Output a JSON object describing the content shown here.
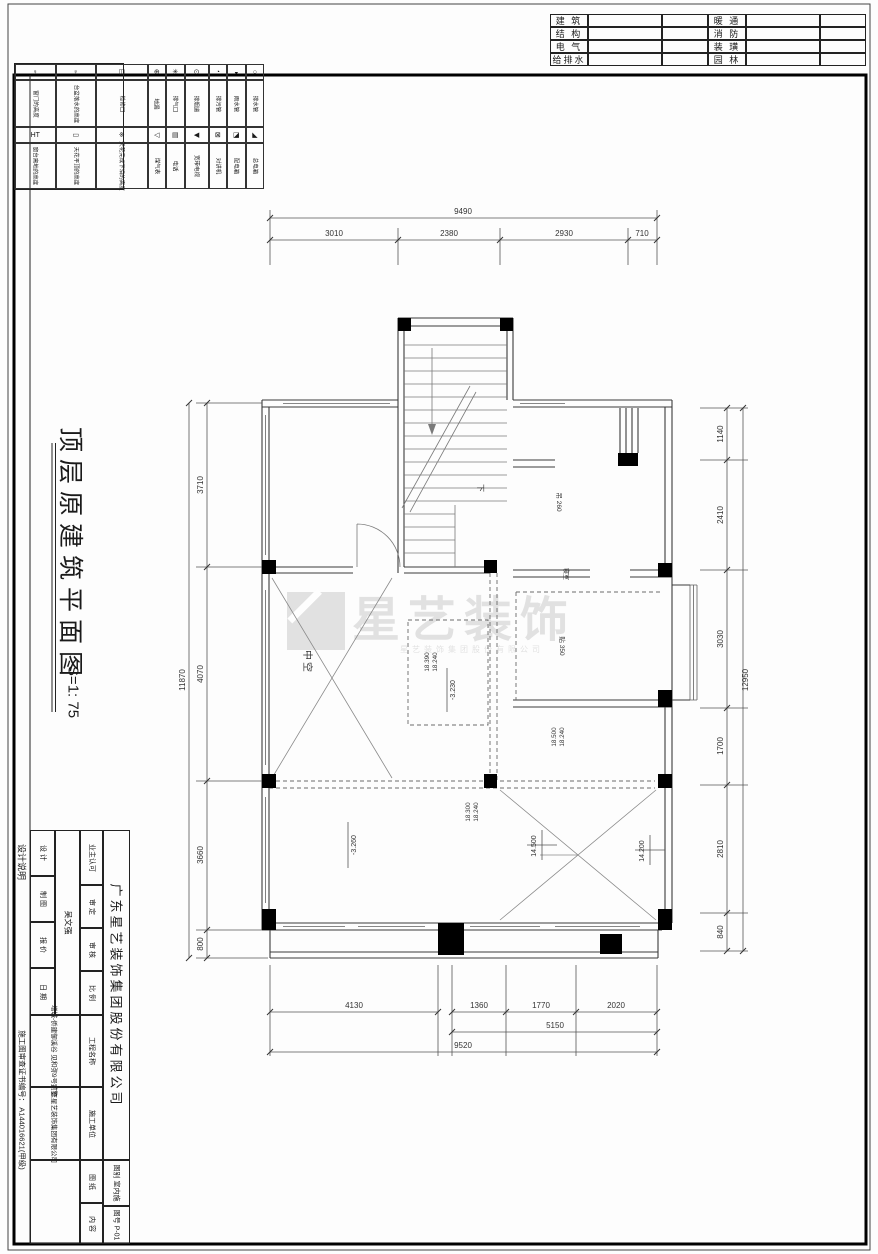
{
  "sheet": {
    "disciplines": {
      "left": [
        "建 筑",
        "结 构",
        "电 气",
        "给排水"
      ],
      "right": [
        "暖 通",
        "消 防",
        "装 璜",
        "园 林"
      ]
    },
    "legend": {
      "columns": [
        {
          "sym1": "♀",
          "label1": "窗门的高度",
          "sym2": "HT",
          "label2": "窗台离地的高度"
        },
        {
          "sym1": "♀",
          "label1": "台盆落水的高度",
          "sym2": "▭",
          "label2": "天花平顶的高度"
        },
        {
          "sym1": "◫",
          "label1": "检修口",
          "sym2": "※",
          "label2": "天花完成下沿的高度"
        },
        {
          "sym1": "⊕",
          "label1": "地漏",
          "sym2": "◁",
          "label2": "煤气表"
        },
        {
          "sym1": "✳",
          "label1": "排气口",
          "sym2": "▤",
          "label2": "电话"
        },
        {
          "sym1": "⊙",
          "label1": "排烟道",
          "sym2": "◀",
          "label2": "宽带电视"
        },
        {
          "sym1": "◔",
          "label1": "排污管",
          "sym2": "⊠",
          "label2": "对讲机"
        },
        {
          "sym1": "◒",
          "label1": "雨水管",
          "sym2": "◪",
          "label2": "配电箱"
        },
        {
          "sym1": "○",
          "label1": "排水管",
          "sym2": "◣",
          "label2": "总电箱"
        }
      ]
    },
    "title": {
      "text": "顶层原建筑平面图",
      "scale": "S=1: 75"
    },
    "notes": {
      "design": "设计说明",
      "cert": "施工图审查证书编号：  A144016621(甲级)"
    },
    "titleblock": {
      "company": "广东星艺装饰集团股份有限公司",
      "roles": [
        "设 计",
        "制 图",
        "报 价",
        "日 期"
      ],
      "designer": "吴文强",
      "approve": "业主认可",
      "checks": [
        "审 定",
        "审 核",
        "比 例"
      ],
      "project_label": "工程名称",
      "project": "增城-侨建御溪谷 见和弥9号别墅",
      "builder_label": "施工单位",
      "builder": "广东星艺装饰集团有限公司",
      "sheet_label": "图 纸",
      "content_label": "内 容",
      "cat_label": "图别",
      "cat": "室内施",
      "no_label": "图号",
      "no": "P-01"
    }
  },
  "plan": {
    "rooms": {
      "void": "中空",
      "down": "下",
      "note_c": "吊 260",
      "note_wall": "寝室",
      "note_f": "贴 350"
    },
    "levels": {
      "p1a": "18.390",
      "p1b": "18.240",
      "p2a": "18.500",
      "p2b": "18.240",
      "p3a": "18.300",
      "p3b": "18.240",
      "d1": "-3.230",
      "d2": "-3.260",
      "l1": "14.500",
      "l2": "14.200"
    },
    "watermark": {
      "text": "星艺装饰",
      "sub": "星艺装饰集团股份有限公司"
    },
    "dims": {
      "top": {
        "total": "9490",
        "segs": [
          "3010",
          "2380",
          "2930",
          "710"
        ]
      },
      "left": {
        "total": "11870",
        "segs": [
          "3710",
          "4070",
          "3660",
          "800"
        ]
      },
      "right": {
        "total": "12950",
        "segs": [
          "1140",
          "2410",
          "3030",
          "1700",
          "2810",
          "840"
        ]
      },
      "bottom": {
        "total": "9520",
        "subtotal": "5150",
        "seg0": "4130",
        "segs": [
          "1360",
          "1770",
          "2020"
        ]
      }
    }
  }
}
